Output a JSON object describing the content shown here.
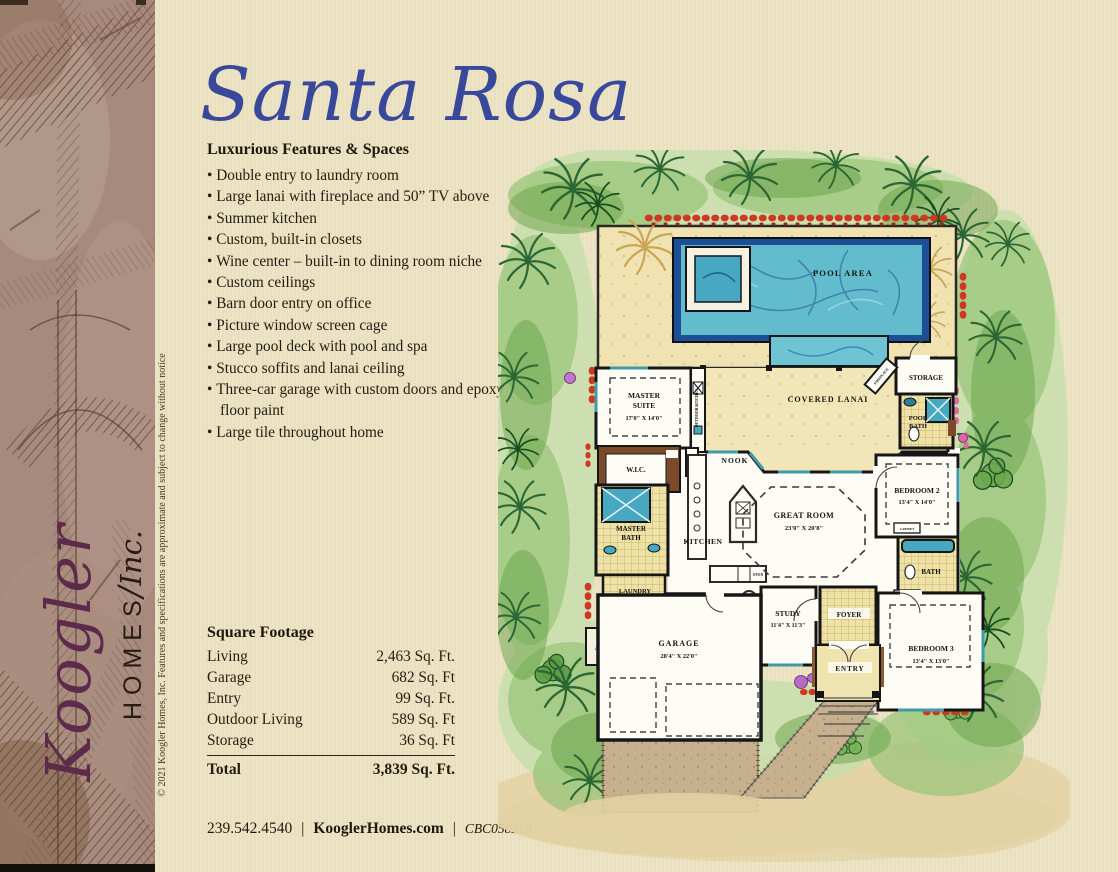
{
  "sidebar": {
    "brand_script": "Koogler",
    "brand_homes": "HOMES",
    "brand_slash": "/",
    "brand_inc": "Inc.",
    "copyright": "© 2021 Koogler Homes, Inc. Features and specifications are approximate and subject to change without notice"
  },
  "header": {
    "title": "Santa Rosa"
  },
  "features": {
    "heading": "Luxurious Features & Spaces",
    "items": [
      "Double entry to laundry room",
      "Large lanai with fireplace and 50” TV above",
      "Summer kitchen",
      "Custom, built-in closets",
      "Wine center – built-in to dining room niche",
      "Custom ceilings",
      "Barn door entry on office",
      "Picture window screen cage",
      "Large pool deck with pool and spa",
      "Stucco soffits and lanai ceiling",
      "Three-car garage with custom doors and epoxy floor paint",
      "Large tile throughout home"
    ]
  },
  "square_footage": {
    "heading": "Square Footage",
    "rows": [
      {
        "label": "Living",
        "value": "2,463 Sq. Ft."
      },
      {
        "label": "Garage",
        "value": "682 Sq. Ft"
      },
      {
        "label": "Entry",
        "value": "99 Sq. Ft."
      },
      {
        "label": "Outdoor Living",
        "value": "589 Sq. Ft"
      },
      {
        "label": "Storage",
        "value": "36 Sq. Ft"
      }
    ],
    "total": {
      "label": "Total",
      "value": "3,839 Sq. Ft."
    }
  },
  "footer": {
    "phone": "239.542.4540",
    "separator": "|",
    "website": "KooglerHomes.com",
    "license": "CBC058219"
  },
  "floor_plan": {
    "labels": {
      "pool_area": "POOL AREA",
      "covered_lanai": "COVERED LANAI",
      "storage": "STORAGE",
      "fireplace": "FIREPLACE",
      "pool_bath_l1": "POOL",
      "pool_bath_l2": "BATH",
      "master_suite_l1": "MASTER",
      "master_suite_l2": "SUITE",
      "master_suite_dims": "17'0\" X 14'0\"",
      "wic": "W.I.C.",
      "outdoor_kitchen": "OUTDOOR KITCHEN",
      "hutch": "HUTCH",
      "nook": "NOOK",
      "great_room": "GREAT ROOM",
      "great_room_dims": "23'0\" X 20'8\"",
      "kitchen": "KITCHEN",
      "oven": "OVEN",
      "master_bath_l1": "MASTER",
      "master_bath_l2": "BATH",
      "laundry": "LAUNDRY",
      "dryer": "D.",
      "washer": "W.",
      "pantry": "PANTRY",
      "ac": "A/C",
      "bedroom2": "BEDROOM 2",
      "bedroom2_dims": "13'4\" X 14'0\"",
      "bath": "BATH",
      "cabinet_upper": "CABINET",
      "cabinet_lower": "CABINET",
      "bedroom3": "BEDROOM 3",
      "bedroom3_dims": "13'4\" X 13'0\"",
      "study": "STUDY",
      "study_dims": "11'4\" X 11'3\"",
      "foyer": "FOYER",
      "entry": "ENTRY",
      "garage": "GARAGE",
      "garage_dims": "28'4\" X 22'0\""
    },
    "colors": {
      "pool_border": "#1c4f93",
      "pool_water": "#63bccd",
      "deck_tan": "#f0e3b1",
      "grass_green": "#97c477",
      "wall_black": "#161616",
      "tile_yellow": "#efe2a6",
      "accent_red_flowers": "#cf3722",
      "title_blue": "#3a489c",
      "brand_maroon": "#5e2a4b"
    }
  }
}
